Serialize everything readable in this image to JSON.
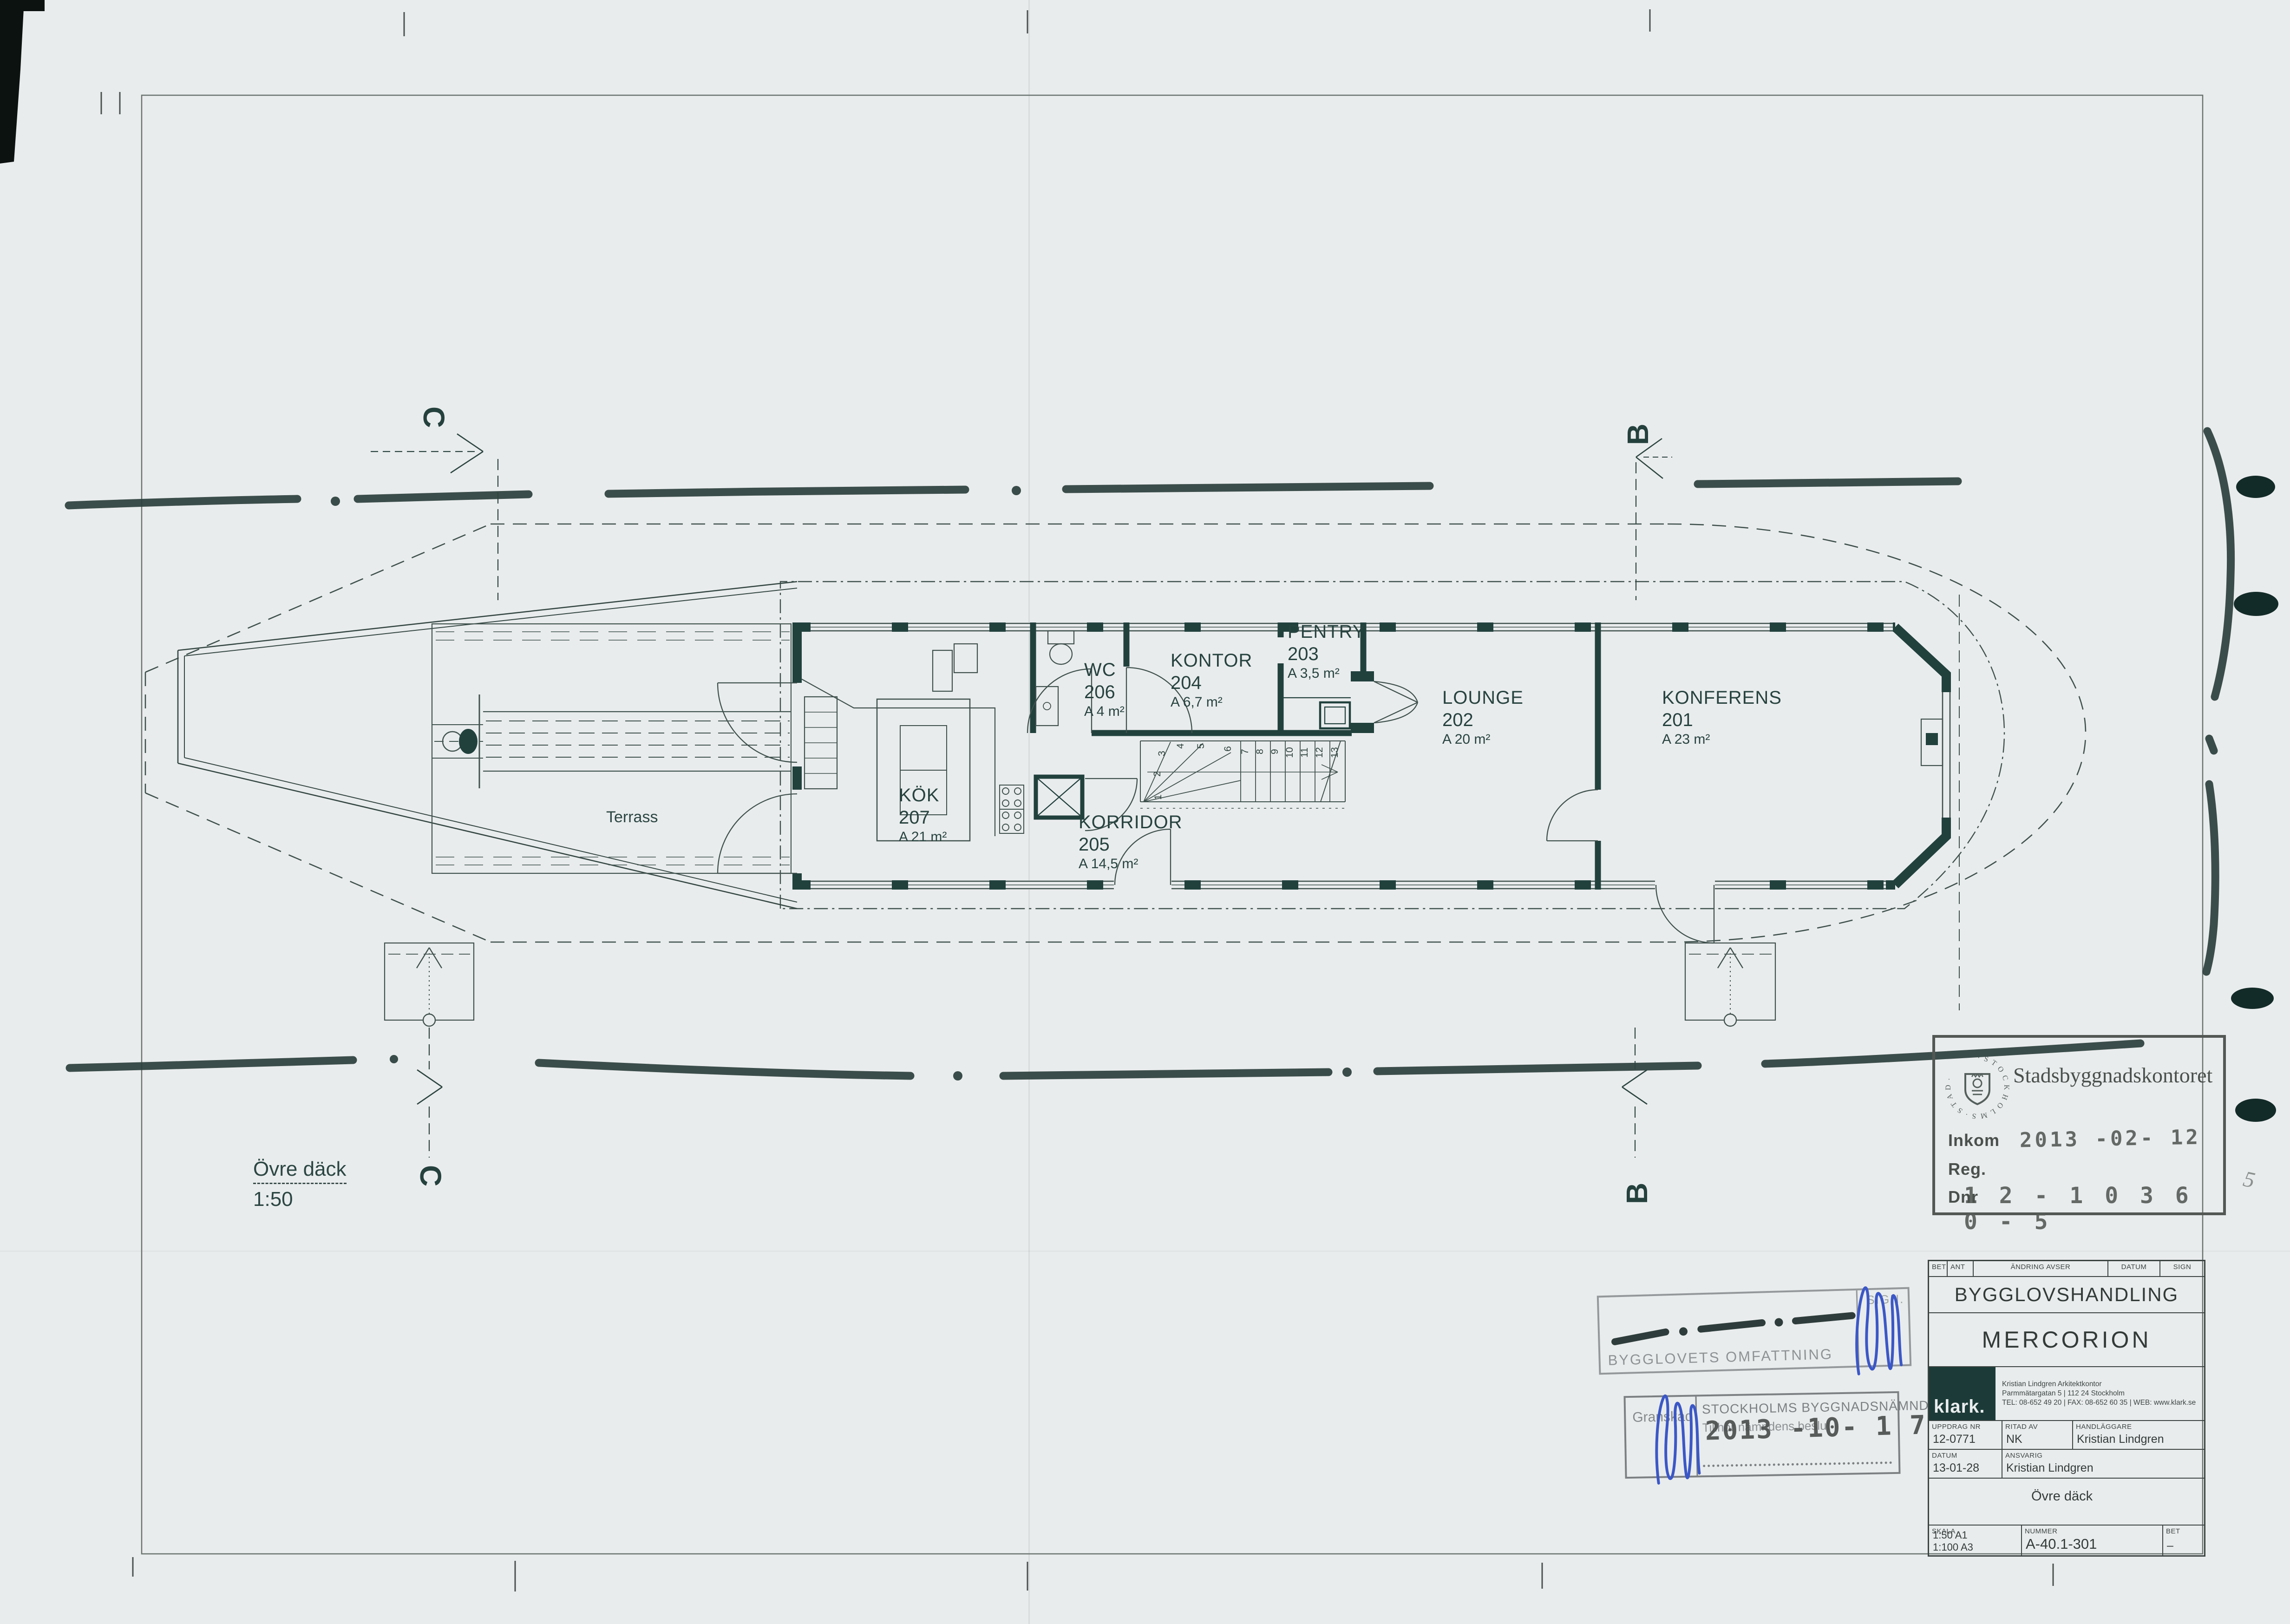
{
  "plan": {
    "rooms": [
      {
        "name": "KONFERENS",
        "number": "201",
        "area": "A 23 m²"
      },
      {
        "name": "LOUNGE",
        "number": "202",
        "area": "A 20 m²"
      },
      {
        "name": "PENTRY",
        "number": "203",
        "area": "A 3,5 m²"
      },
      {
        "name": "KONTOR",
        "number": "204",
        "area": "A 6,7 m²"
      },
      {
        "name": "KORRIDOR",
        "number": "205",
        "area": "A 14,5 m²"
      },
      {
        "name": "WC",
        "number": "206",
        "area": "A 4 m²"
      },
      {
        "name": "KÖK",
        "number": "207",
        "area": "A 21 m²"
      }
    ],
    "terrace_label": "Terrass",
    "drawing_label": "Övre däck",
    "scale_label": "1:50",
    "section_markers": {
      "top_left": "C",
      "top_right": "B",
      "bottom_left": "C",
      "bottom_right": "B"
    },
    "stair_numbers": [
      "1",
      "2",
      "3",
      "4",
      "5",
      "6",
      "7",
      "8",
      "9",
      "10",
      "11",
      "12",
      "13"
    ]
  },
  "stamps": {
    "sbk": {
      "office": "Stadsbyggnadskontoret",
      "emblem_text": "· S T O C K H O L M S · S T A D ·",
      "received_label": "Inkom",
      "received_date": "2013 -02- 12",
      "reg_label": "Reg.",
      "dnr_label": "Dnr",
      "dnr_value": "1 2 - 1 0 3 6 0 - 5",
      "handwritten_note": "5"
    },
    "scope": {
      "text": "BYGGLOVETS OMFATTNING",
      "sign_label": "SIGN."
    },
    "review": {
      "granskad_label": "Granskad",
      "board": "STOCKHOLMS BYGGNADSNÄMND",
      "subtext": "Tillhör nämndens beslut",
      "date": "2013 -10- 1 7"
    }
  },
  "titleblock": {
    "rev_headers": [
      "BET",
      "ANT",
      "ÄNDRING AVSER",
      "DATUM",
      "SIGN"
    ],
    "doc_type": "BYGGLOVSHANDLING",
    "project": "MERCORION",
    "logo": "klark.",
    "firm_line1": "Kristian Lindgren Arkitektkontor",
    "firm_line2": "Parmmätargatan 5 | 112 24 Stockholm",
    "firm_line3": "TEL: 08-652 49 20 | FAX: 08-652 60 35 | WEB: www.klark.se",
    "uppdrag_label": "UPPDRAG NR",
    "uppdrag": "12-0771",
    "ritad_label": "RITAD AV",
    "ritad": "NK",
    "handlaggare_label": "HANDLÄGGARE",
    "handlaggare": "Kristian Lindgren",
    "datum_label": "DATUM",
    "datum": "13-01-28",
    "ansvarig_label": "ANSVARIG",
    "ansvarig": "Kristian Lindgren",
    "content": "Övre däck",
    "skala_label": "SKALA",
    "skala1": "1:50 A1",
    "skala2": "1:100 A3",
    "nummer_label": "NUMMER",
    "nummer": "A-40.1-301",
    "bet_label": "BET",
    "bet": "–"
  },
  "colors": {
    "ink": "#21413d",
    "thin": "#3f514d",
    "marker": "#2b3f3c",
    "paper": "#e9eced",
    "pen_blue": "#3b57c7"
  }
}
